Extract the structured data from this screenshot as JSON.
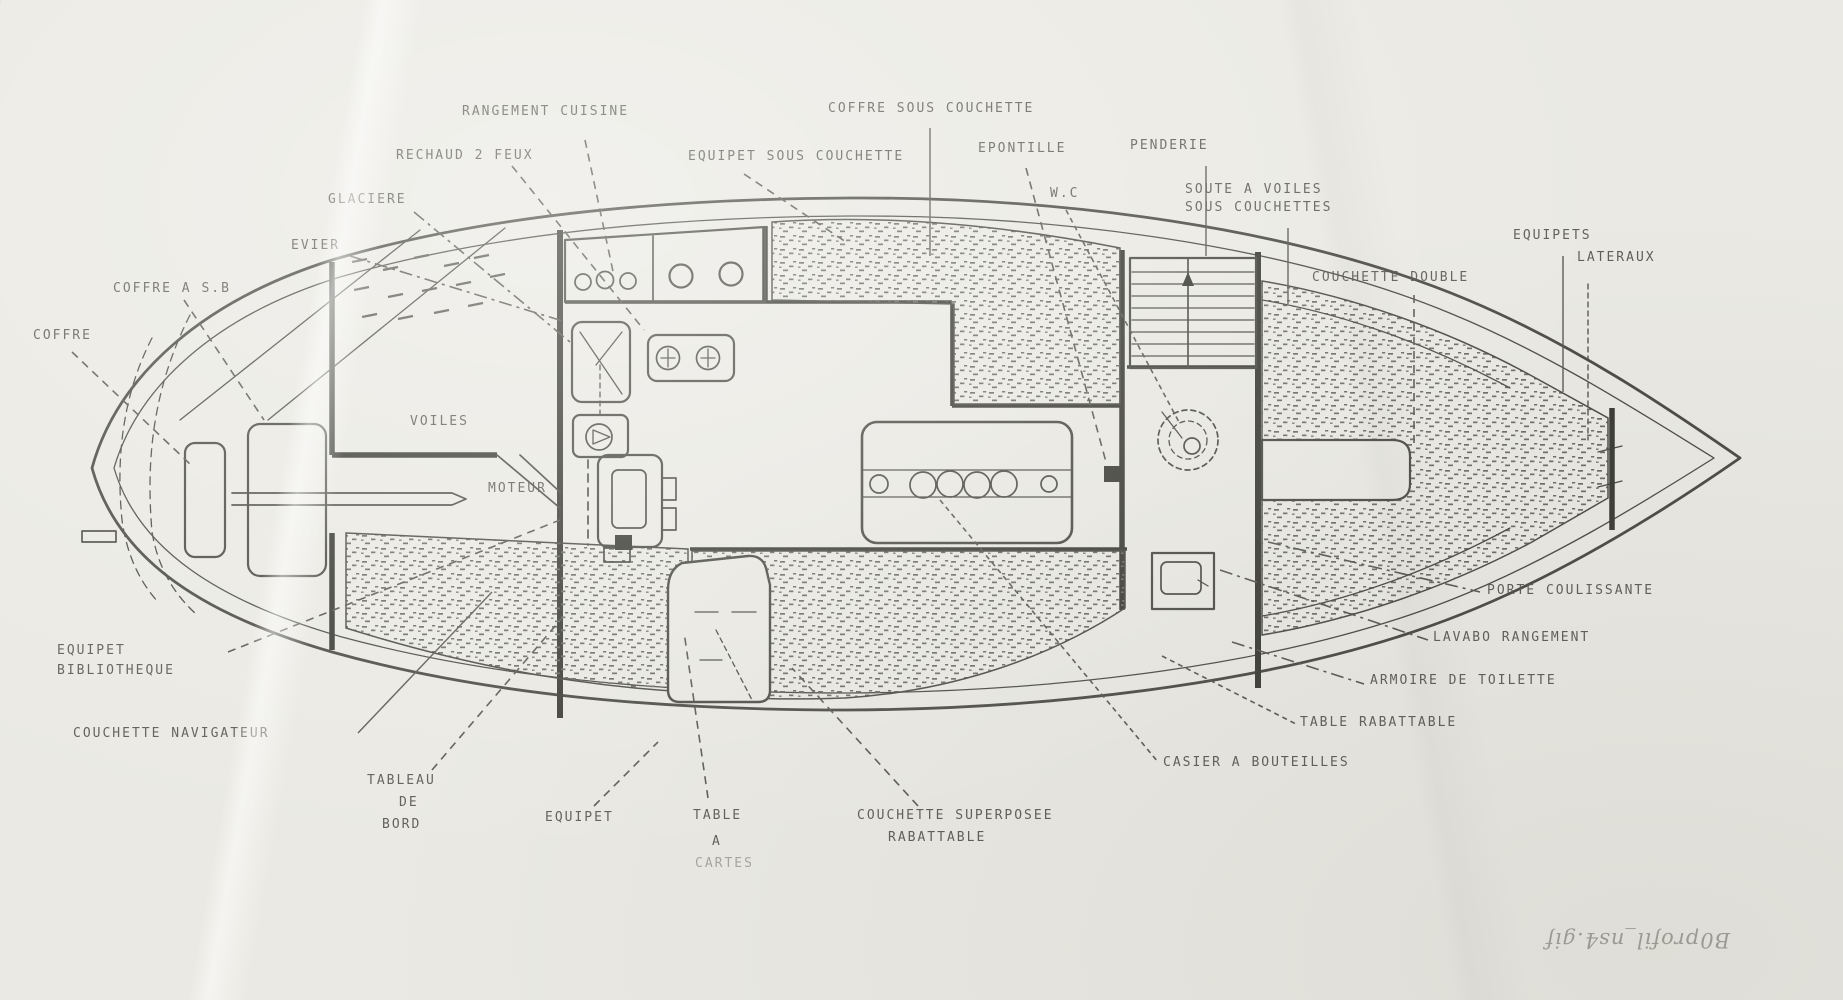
{
  "document": {
    "kind": "scanned sailboat interior layout plan (plan d'aménagement)",
    "caption_rotated": "B0profil_ns4.gif"
  },
  "colors": {
    "paper": "#eae9e3",
    "ink": "#4c4c45",
    "ink_dark": "#3d3d37",
    "label_ink": "#55544c"
  },
  "labels": {
    "rangement_cuisine": "RANGEMENT CUISINE",
    "coffre_sous_couchette": "COFFRE SOUS COUCHETTE",
    "rechaud_2_feux": "RECHAUD 2 FEUX",
    "equipet_sous_couchette": "EQUIPET SOUS COUCHETTE",
    "epontille": "EPONTILLE",
    "penderie": "PENDERIE",
    "glaciere": "GLACIERE",
    "wc": "W.C",
    "soute_line1": "SOUTE A VOILES",
    "soute_line2": "SOUS COUCHETTES",
    "evier": "EVIER",
    "couchette_double": "COUCHETTE DOUBLE",
    "equipets_line1": "EQUIPETS",
    "equipets_line2": "LATERAUX",
    "coffre_a_sb": "COFFRE A S.B",
    "coffre": "COFFRE",
    "voiles": "VOILES",
    "moteur": "MOTEUR",
    "porte_coulissante": "PORTE COULISSANTE",
    "lavabo_rangement": "LAVABO RANGEMENT",
    "armoire_de_toilette": "ARMOIRE DE TOILETTE",
    "table_rabattable": "TABLE RABATTABLE",
    "equipet_bibliotheque_line1": "EQUIPET",
    "equipet_bibliotheque_line2": "BIBLIOTHEQUE",
    "casier_a_bouteilles": "CASIER A BOUTEILLES",
    "couchette_navigateur": "COUCHETTE NAVIGATEUR",
    "tableau_line1": "TABLEAU",
    "tableau_line2": "DE",
    "tableau_line3": "BORD",
    "equipet": "EQUIPET",
    "table_a_cartes_line1": "TABLE",
    "table_a_cartes_line2": "A",
    "table_a_cartes_line3": "CARTES",
    "couchette_superposee_line1": "COUCHETTE SUPERPOSEE",
    "couchette_superposee_line2": "RABATTABLE"
  }
}
